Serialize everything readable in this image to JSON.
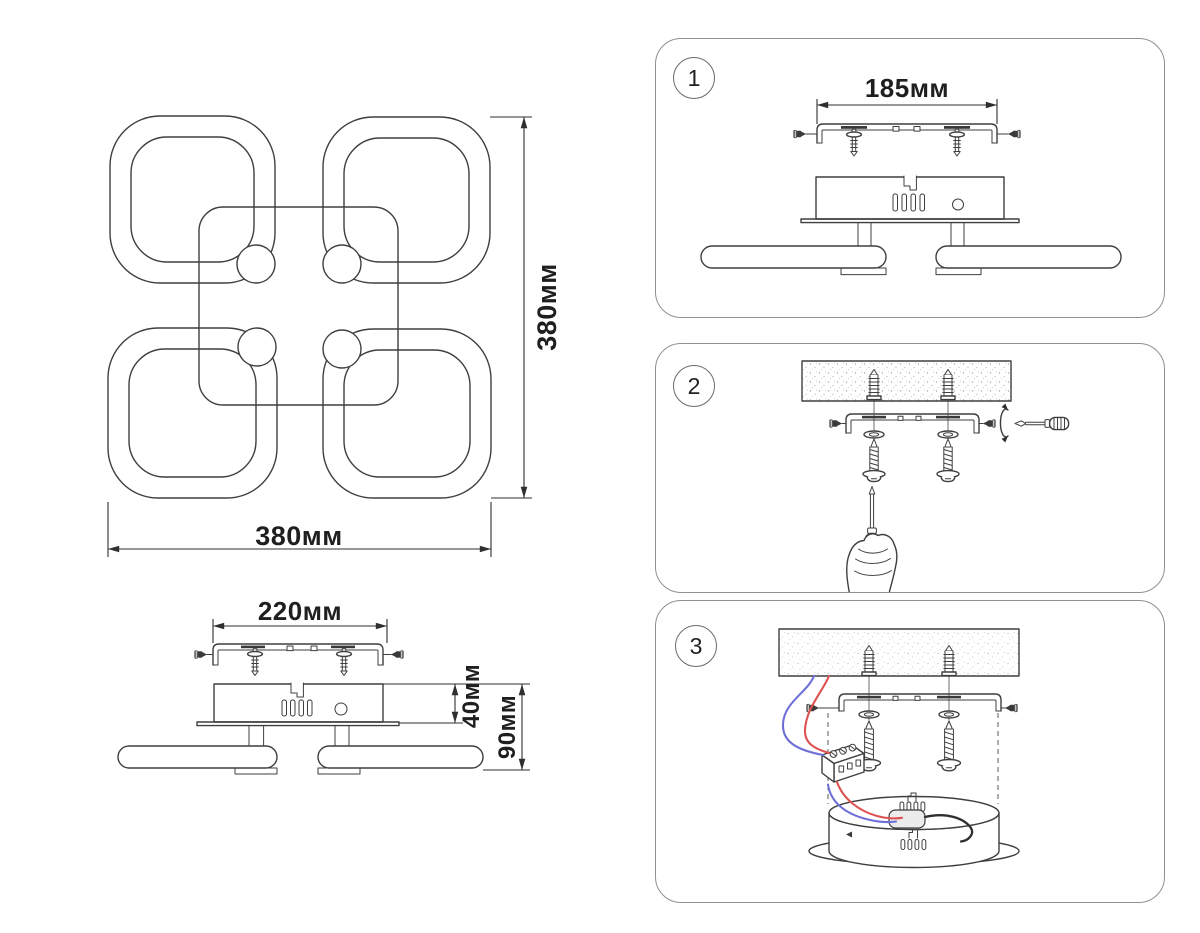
{
  "sheet": {
    "background_color": "#ffffff",
    "line_color": "#3f3f3f",
    "dim_text_color": "#1f1f1f",
    "panel_border_color": "#909090"
  },
  "top_view": {
    "width_label": "380мм",
    "height_label": "380мм"
  },
  "side_view": {
    "width_label": "220мм",
    "body_height_label": "40мм",
    "total_height_label": "90мм"
  },
  "steps": [
    {
      "number": "1",
      "dimension_label": "185мм"
    },
    {
      "number": "2"
    },
    {
      "number": "3"
    }
  ],
  "colors": {
    "wire_live": "#de5252",
    "wire_neutral": "#6f6fd8",
    "driver_box_fill": "#ececec",
    "hardware_dark": "#3a3a3a",
    "ceiling_dot": "#a8a8a8"
  }
}
